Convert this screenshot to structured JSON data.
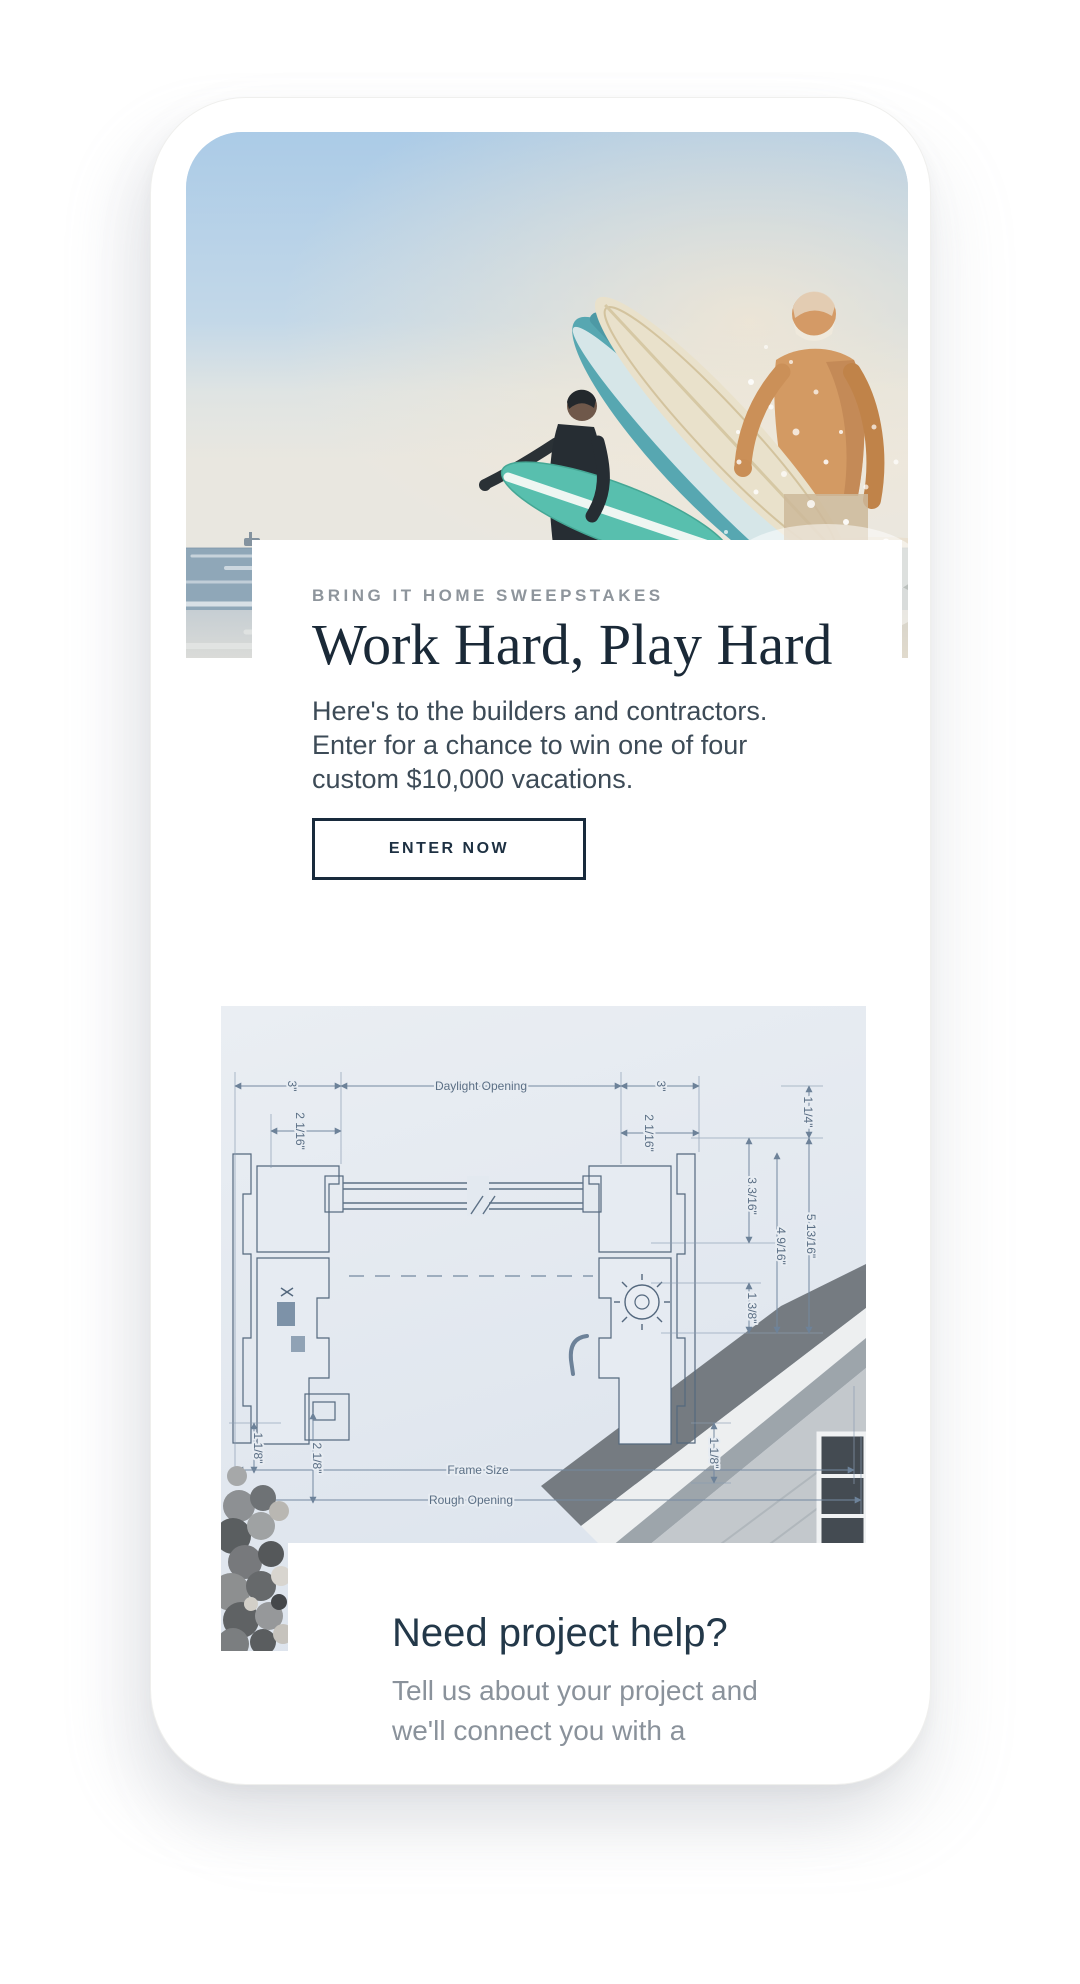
{
  "hero": {
    "eyebrow": "BRING IT HOME SWEEPSTAKES",
    "title": "Work Hard, Play Hard",
    "body_lines": [
      "Here's to the builders and contractors.",
      "Enter for a chance to win one of four",
      "custom $10,000 vacations."
    ],
    "cta_label": "ENTER NOW"
  },
  "help": {
    "title": "Need project help?",
    "body_lines": [
      "Tell us about your project and",
      "we'll connect you with a"
    ]
  },
  "diagram": {
    "labels": [
      {
        "text": "3\"",
        "x": 67,
        "y": 80,
        "rot": 90
      },
      {
        "text": "Daylight Opening",
        "x": 260,
        "y": 84,
        "rot": 0
      },
      {
        "text": "3\"",
        "x": 436,
        "y": 80,
        "rot": 90
      },
      {
        "text": "2 1/16\"",
        "x": 75,
        "y": 125,
        "rot": 90
      },
      {
        "text": "2 1/16\"",
        "x": 424,
        "y": 127,
        "rot": 90
      },
      {
        "text": "1 1/4\"",
        "x": 583,
        "y": 106,
        "rot": 90
      },
      {
        "text": "3 3/16\"",
        "x": 527,
        "y": 190,
        "rot": 90
      },
      {
        "text": "4 9/16\"",
        "x": 556,
        "y": 240,
        "rot": 90
      },
      {
        "text": "5 13/16\"",
        "x": 586,
        "y": 230,
        "rot": 90
      },
      {
        "text": "1 3/8\"",
        "x": 527,
        "y": 302,
        "rot": 90
      },
      {
        "text": "1 1/8\"",
        "x": 33,
        "y": 442,
        "rot": 90
      },
      {
        "text": "2 1/8\"",
        "x": 92,
        "y": 452,
        "rot": 90
      },
      {
        "text": "1 1/8\"",
        "x": 489,
        "y": 447,
        "rot": 90
      },
      {
        "text": "Frame Size",
        "x": 257,
        "y": 468,
        "rot": 0
      },
      {
        "text": "Rough Opening",
        "x": 250,
        "y": 498,
        "rot": 0
      }
    ]
  },
  "colors": {
    "accent_navy": "#1a2937",
    "eyebrow_gray": "#8e959c",
    "body_gray": "#3d4b57",
    "muted_gray": "#8a929b",
    "blueprint_line": "#7388a0",
    "board_teal": "#58bfae"
  }
}
